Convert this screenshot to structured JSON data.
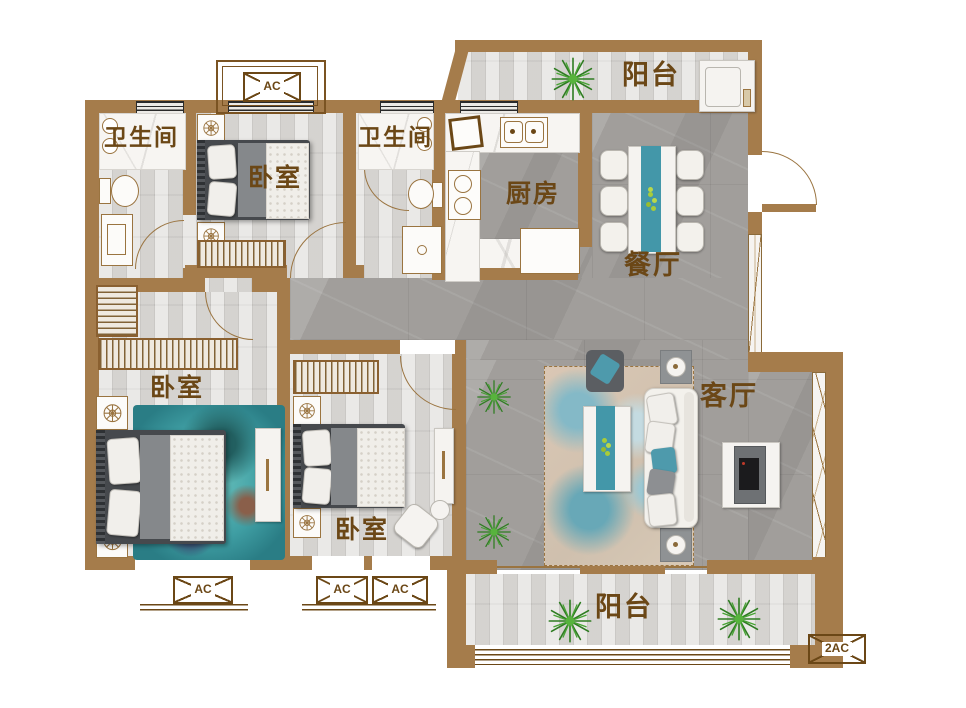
{
  "floorplan": {
    "rooms": {
      "balcony_top": {
        "label": "阳台"
      },
      "bathroom_1": {
        "label": "卫生间"
      },
      "bedroom_top": {
        "label": "卧室"
      },
      "bathroom_2": {
        "label": "卫生间"
      },
      "kitchen": {
        "label": "厨房"
      },
      "dining": {
        "label": "餐厅"
      },
      "living": {
        "label": "客厅"
      },
      "bedroom_left": {
        "label": "卧室"
      },
      "bedroom_mid": {
        "label": "卧室"
      },
      "balcony_bottom": {
        "label": "阳台"
      }
    },
    "ac_units": {
      "top": {
        "label": "AC"
      },
      "bottom_left": {
        "label": "AC"
      },
      "bottom_mid_1": {
        "label": "AC"
      },
      "bottom_mid_2": {
        "label": "AC"
      },
      "bottom_right": {
        "label": "2AC"
      }
    },
    "colors": {
      "wall": "#a57c4b",
      "accent_teal": "#4397a9",
      "label_brown": "#6b4716",
      "plant_green": "#3a8c28"
    }
  }
}
